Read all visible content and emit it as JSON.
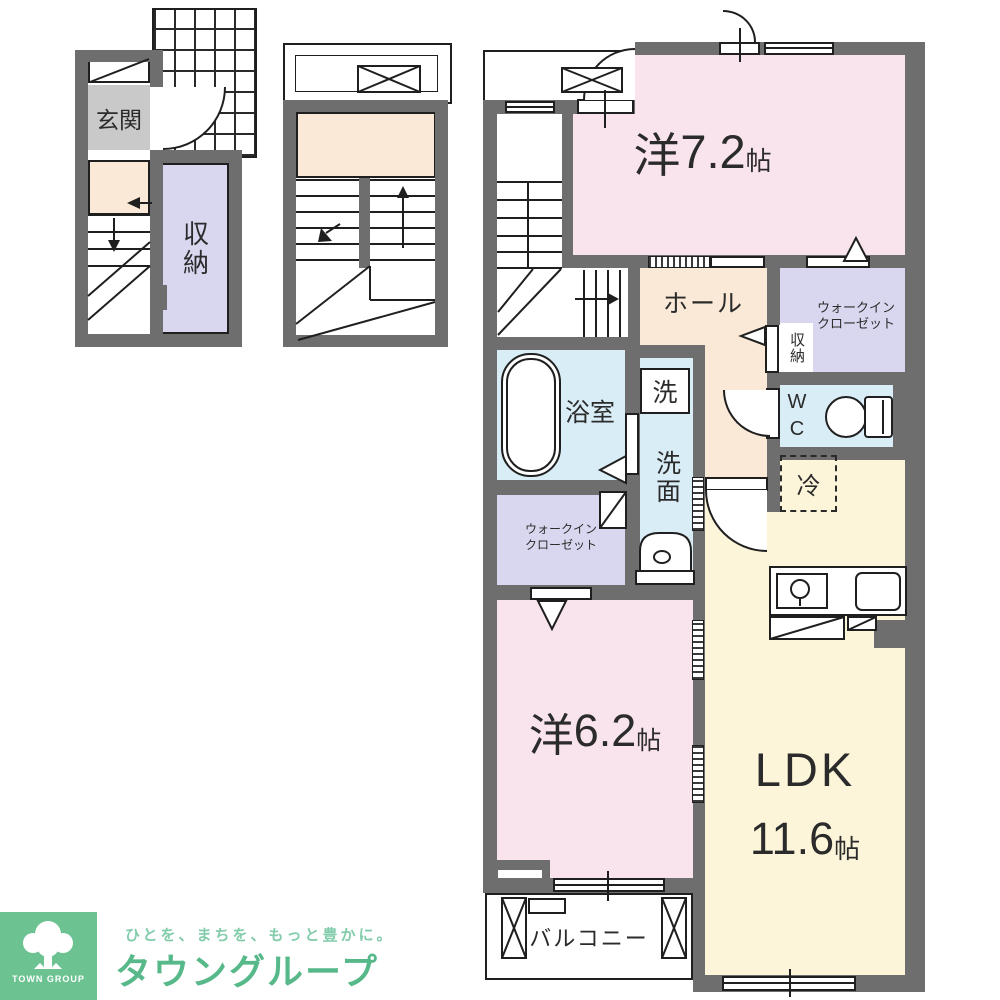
{
  "floor1": {
    "entrance_label": "玄関",
    "storage_label": "収納"
  },
  "main": {
    "room_west_72": {
      "prefix": "洋",
      "size": "7.2",
      "unit": "帖"
    },
    "hall_label": "ホール",
    "walkin_closet_line1": "ウォークイン",
    "walkin_closet_line2": "クローゼット",
    "storage_label": "収納",
    "wc_line1": "W",
    "wc_line2": "C",
    "bath_label": "浴室",
    "washer_label": "洗",
    "washroom_label": "洗面",
    "fridge_label": "冷",
    "room_west_62": {
      "prefix": "洋",
      "size": "6.2",
      "unit": "帖"
    },
    "ldk": {
      "name": "LDK",
      "size": "11.6",
      "unit": "帖"
    },
    "balcony_label": "バルコニー"
  },
  "logo": {
    "tagline": "ひとを、まちを、もっと豊かに。",
    "brand": "タウングループ",
    "mark": "TOWN GROUP"
  },
  "colors": {
    "wall": "#6f6e6e",
    "ink": "#1f1f1f",
    "pink": "#f9e3ec",
    "peach": "#fbe9d8",
    "cream": "#fcf5da",
    "blue": "#d9edf6",
    "purple": "#d8d7ef",
    "graybox": "#c9c9c9",
    "green_square": "#6cc291",
    "green_brand": "#57b88a",
    "green_tagline": "#82ccaa"
  }
}
